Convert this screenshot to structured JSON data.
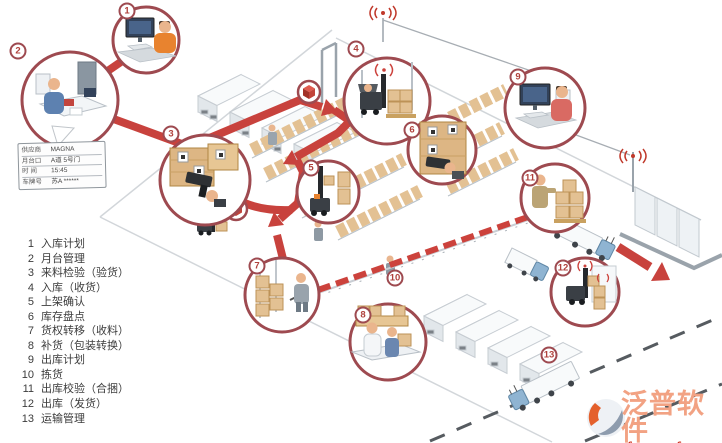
{
  "legend": {
    "items": [
      {
        "num": "1",
        "label": "入库计划"
      },
      {
        "num": "2",
        "label": "月台管理"
      },
      {
        "num": "3",
        "label": "来料检验（验货）"
      },
      {
        "num": "4",
        "label": "入库（收货）"
      },
      {
        "num": "5",
        "label": "上架确认"
      },
      {
        "num": "6",
        "label": "库存盘点"
      },
      {
        "num": "7",
        "label": "货权转移（收料）"
      },
      {
        "num": "8",
        "label": "补货（包装转换）"
      },
      {
        "num": "9",
        "label": "出库计划"
      },
      {
        "num": "10",
        "label": "拣货"
      },
      {
        "num": "11",
        "label": "出库校验（合捆）"
      },
      {
        "num": "12",
        "label": "出库（发货）"
      },
      {
        "num": "13",
        "label": "运输管理"
      }
    ]
  },
  "supplier_card": {
    "rows": [
      {
        "label": "供应商",
        "value": "MAGNA"
      },
      {
        "label": "月台口",
        "value": "A道 5号门"
      },
      {
        "label": "时 间",
        "value": "15:45"
      },
      {
        "label": "车牌号",
        "value": "苏A ******"
      }
    ]
  },
  "watermark": {
    "brand": "泛普软件",
    "url": "www.fanpusoft.com"
  },
  "icons": {
    "wireless": "wireless-signal-icon",
    "package": "package-cube-icon"
  },
  "colors": {
    "flow": "#c8423d",
    "circle_border": "#9e4a50",
    "crate": "#e3c193",
    "truck_cab": "#8fb4d2",
    "brand": "#f2a283",
    "url": "#cf2c1a"
  }
}
